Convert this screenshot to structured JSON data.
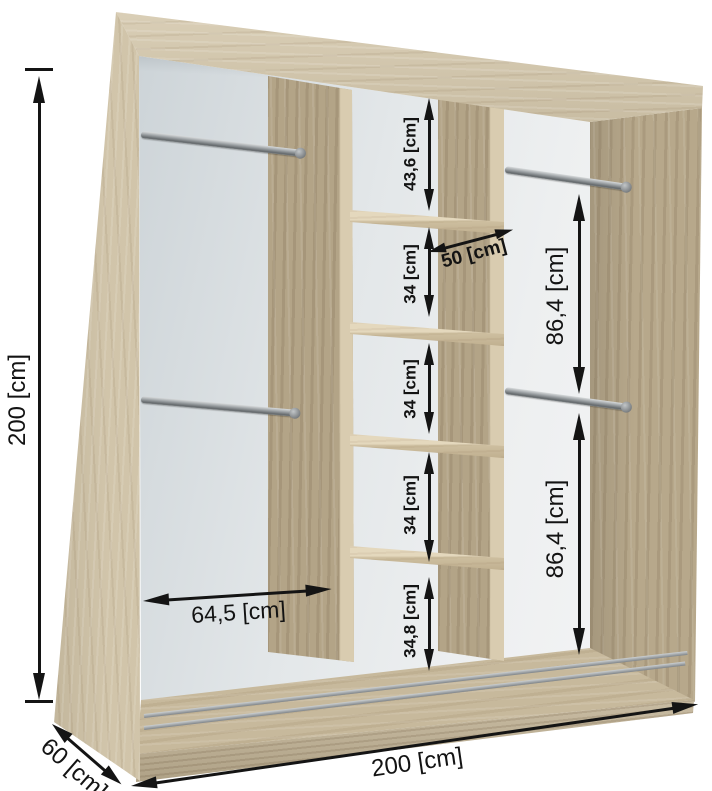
{
  "diagram": {
    "subject": "sliding-door wardrobe interior with shelves and hanging rails",
    "units": "cm",
    "dimensions": {
      "overall": {
        "height": "200 [cm]",
        "width": "200 [cm]",
        "depth": "60 [cm]"
      },
      "left_compartment": {
        "width": "64,5 [cm]",
        "hanging_rails": 2
      },
      "middle_column": {
        "shelf_depth": "50 [cm]",
        "sections": [
          "43,6 [cm]",
          "34 [cm]",
          "34 [cm]",
          "34 [cm]",
          "34,8 [cm]"
        ],
        "shelf_count": 4
      },
      "right_compartment": {
        "sections": [
          "86,4 [cm]",
          "86,4 [cm]"
        ],
        "hanging_rails": 2
      }
    },
    "colors": {
      "wood_light": "#cec1a5",
      "wood_medium": "#b7a88b",
      "back_panel": "#e9ecee",
      "dimension_ink": "#141414",
      "rail_metal": "#8f9497",
      "background": "#ffffff"
    }
  }
}
